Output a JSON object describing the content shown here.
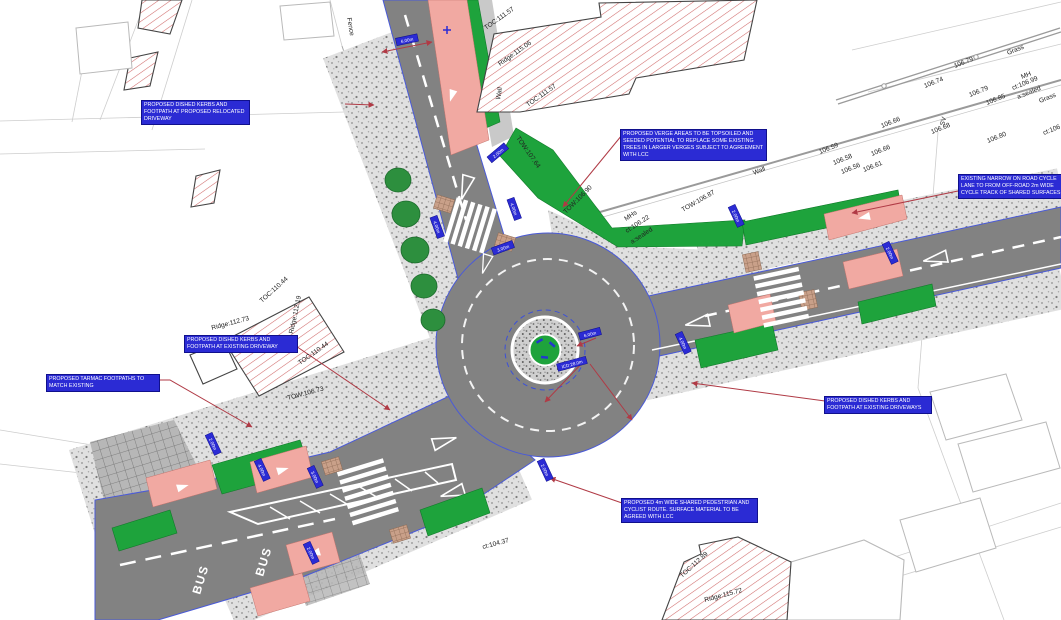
{
  "drawing_type": "proposed roundabout junction engineering plan",
  "colors": {
    "carriageway": "#828282",
    "verge_green": "#1ea33c",
    "cycle_lane_pink": "#f1a9a2",
    "note_blue": "#2b2bd4",
    "leader_red": "#b03a45",
    "building_hatch_red": "#d06a6a",
    "kerb_blue": "#4a5ad8"
  },
  "notes": [
    {
      "text": "PROPOSED DISHED KERBS AND FOOTPATH AT PROPOSED RELOCATED DRIVEWAY"
    },
    {
      "text": "PROPOSED VERGE AREAS TO BE TOPSOILED AND SEEDED POTENTIAL TO REPLACE SOME EXISTING TREES IN LARGER VERGES SUBJECT TO AGREEMENT WITH LCC"
    },
    {
      "text": "EXISTING NARROW ON ROAD CYCLE LANE TO FROM OFF-ROAD 2m WIDE CYCLE TRACK OF SHARED SURFACES"
    },
    {
      "text": "PROPOSED DISHED KERBS AND FOOTPATH AT EXISTING DRIVEWAY"
    },
    {
      "text": "PROPOSED TARMAC FOOTPATHS TO MATCH EXISTING"
    },
    {
      "text": "PROPOSED DISHED KERBS AND FOOTPATH AT EXISTING DRIVEWAYS"
    },
    {
      "text": "PROPOSED 4m WIDE SHARED PEDESTRIAN AND CYCLIST ROUTE. SURFACE MATERIAL TO BE AGREED WITH LCC"
    }
  ],
  "levels": [
    {
      "t": "TOC:111.57"
    },
    {
      "t": "Ridge:115.06"
    },
    {
      "t": "TOC:111.57"
    },
    {
      "t": "Wall"
    },
    {
      "t": "Fence"
    },
    {
      "t": "106.79"
    },
    {
      "t": "Grass"
    },
    {
      "t": "106.74"
    },
    {
      "t": "106.79"
    },
    {
      "t": "106.85"
    },
    {
      "t": "MH"
    },
    {
      "t": "ct:106.99"
    },
    {
      "t": "a:sealed"
    },
    {
      "t": "Grass"
    },
    {
      "t": "SV"
    },
    {
      "t": "106.68"
    },
    {
      "t": "106.66"
    },
    {
      "t": "106.59"
    },
    {
      "t": "106.58"
    },
    {
      "t": "106.56"
    },
    {
      "t": "106.61"
    },
    {
      "t": "106.66"
    },
    {
      "t": "106.80"
    },
    {
      "t": "ct:106"
    },
    {
      "t": "Wall"
    },
    {
      "t": "TOW:107.64"
    },
    {
      "t": "TOW:106.90"
    },
    {
      "t": "MHs"
    },
    {
      "t": "ct:106.22"
    },
    {
      "t": "a:sealed"
    },
    {
      "t": "TOW:106.87"
    },
    {
      "t": "TOW:106.73"
    },
    {
      "t": "TOC:110.44"
    },
    {
      "t": "Ridge:112.73"
    },
    {
      "t": "Ridge:112.19"
    },
    {
      "t": "TOC:110.44"
    },
    {
      "t": "TOC:112.89"
    },
    {
      "t": "Ridge:115.72"
    },
    {
      "t": "ct:104.37"
    }
  ],
  "dims": [
    {
      "t": "6.00m"
    },
    {
      "t": "2.00m"
    },
    {
      "t": "4.00m"
    },
    {
      "t": "4.00m"
    },
    {
      "t": "3.00m"
    },
    {
      "t": "6.00m"
    },
    {
      "t": "ICD:28.0m"
    },
    {
      "t": "4.00m"
    },
    {
      "t": "2.00m"
    },
    {
      "t": "2.00m"
    },
    {
      "t": "4.00m"
    },
    {
      "t": "3.00m"
    },
    {
      "t": "2.00m"
    },
    {
      "t": "2.00m"
    },
    {
      "t": "2.00m"
    }
  ],
  "road_markings": {
    "bus": "BUS"
  }
}
